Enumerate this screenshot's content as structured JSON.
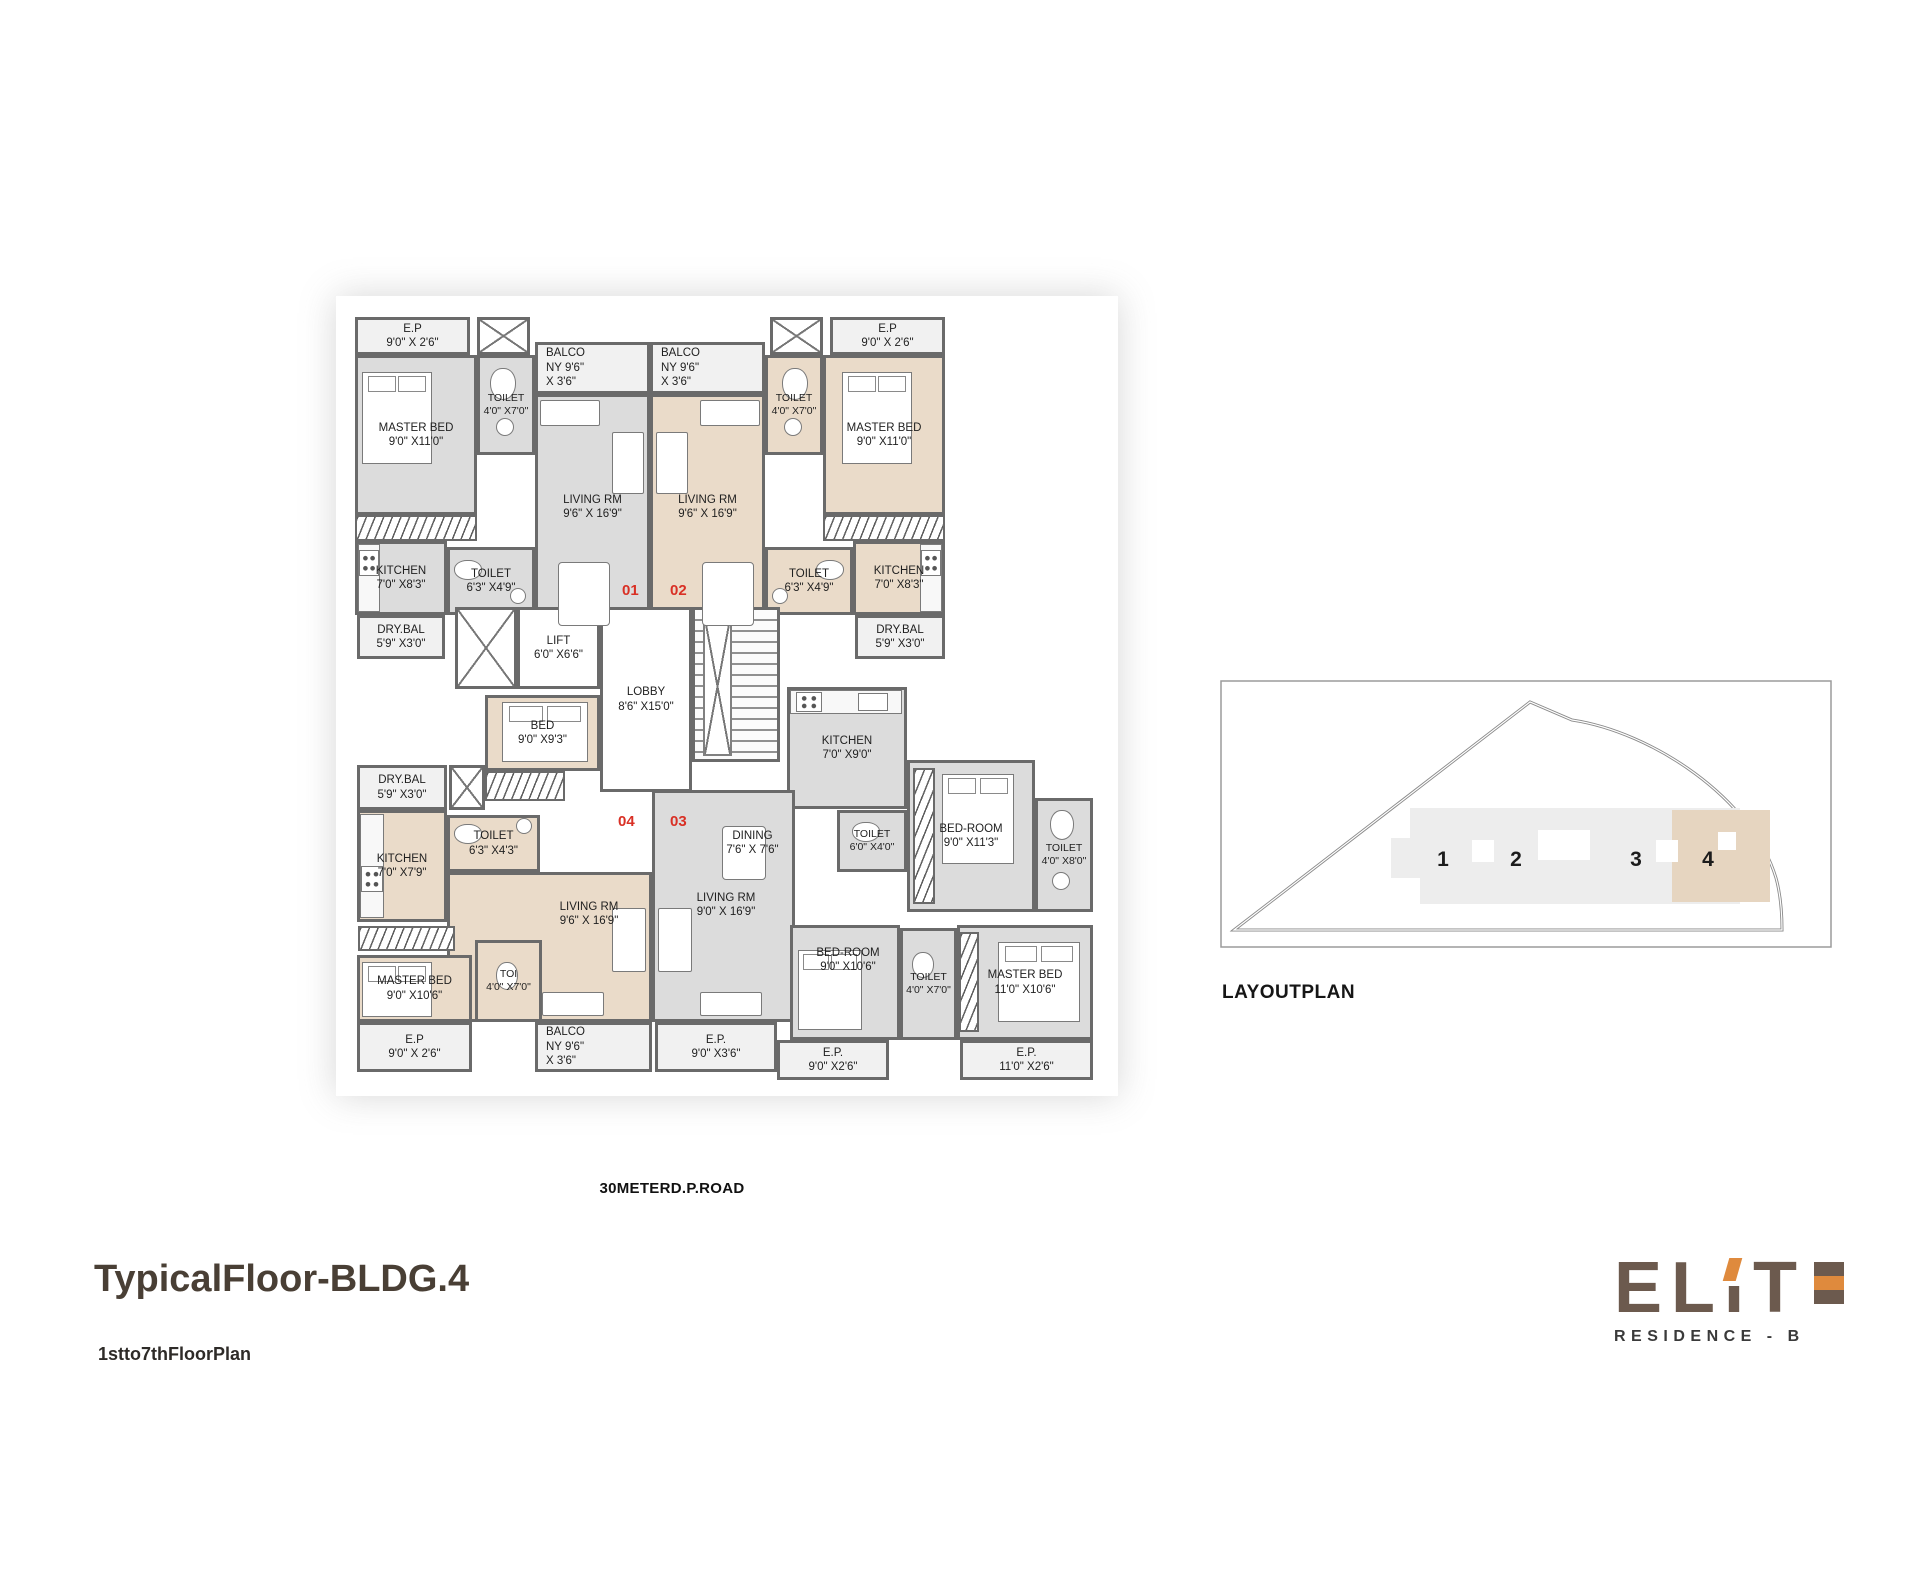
{
  "titles": {
    "main": "TypicalFloor-BLDG.4",
    "sub": "1stto7thFloorPlan"
  },
  "road_label": "30METERD.P.ROAD",
  "layout_plan": {
    "caption": "LAYOUTPLAN",
    "buildings": [
      "1",
      "2",
      "3",
      "4"
    ],
    "highlighted_building": "4"
  },
  "logo": {
    "letters": [
      "E",
      "L",
      "I",
      "T"
    ],
    "residence": "RESIDENCE - B",
    "brown": "#6c5a4e",
    "orange": "#df8a3d"
  },
  "colors": {
    "wall": "#6a6a6a",
    "unit_gray": "#dcdcdc",
    "unit_beige": "#eadbc9",
    "open_fill": "#f1f1f1",
    "unit_number_red": "#d93025"
  },
  "units": [
    {
      "number": "01",
      "x": 272,
      "y": 272
    },
    {
      "number": "02",
      "x": 320,
      "y": 272
    },
    {
      "number": "04",
      "x": 268,
      "y": 503
    },
    {
      "number": "03",
      "x": 320,
      "y": 503
    }
  ],
  "rooms": [
    {
      "id": "floor-unit-01",
      "nb": true,
      "fill": "g",
      "x": 5,
      "y": 45,
      "w": 295,
      "h": 263
    },
    {
      "id": "floor-unit-02",
      "nb": true,
      "fill": "b",
      "x": 300,
      "y": 45,
      "w": 295,
      "h": 263
    },
    {
      "id": "floor-unit-04",
      "nb": true,
      "fill": "b",
      "x": 7,
      "y": 455,
      "w": 295,
      "h": 257
    },
    {
      "id": "floor-unit-03-a",
      "nb": true,
      "fill": "g",
      "x": 437,
      "y": 450,
      "w": 248,
      "h": 262
    },
    {
      "id": "floor-unit-03-b",
      "nb": true,
      "fill": "g",
      "x": 302,
      "y": 480,
      "w": 143,
      "h": 232
    },
    {
      "id": "ep-01",
      "lines": [
        "E.P",
        "9'0\" X 2'6\""
      ],
      "fill": "open",
      "x": 5,
      "y": 7,
      "w": 115,
      "h": 38
    },
    {
      "id": "shaft-top-left",
      "type": "shaft",
      "x": 127,
      "y": 7,
      "w": 53,
      "h": 38
    },
    {
      "id": "master-bed-01",
      "lines": [
        "MASTER BED",
        "9'0\" X11'0\""
      ],
      "fill": "g",
      "x": 5,
      "y": 45,
      "w": 122,
      "h": 160
    },
    {
      "id": "toilet-01-a",
      "lines": [
        "TOILET",
        "4'0\" X7'0\""
      ],
      "fill": "g",
      "x": 127,
      "y": 45,
      "w": 58,
      "h": 100
    },
    {
      "id": "wardrobe-01",
      "type": "hatch",
      "x": 5,
      "y": 205,
      "w": 122,
      "h": 26
    },
    {
      "id": "kitchen-01",
      "lines": [
        "KITCHEN",
        "7'0\" X8'3\""
      ],
      "fill": "g",
      "x": 5,
      "y": 231,
      "w": 92,
      "h": 74
    },
    {
      "id": "toilet-01-b",
      "lines": [
        "TOILET",
        "6'3\" X4'9\""
      ],
      "fill": "g",
      "x": 97,
      "y": 237,
      "w": 88,
      "h": 68
    },
    {
      "id": "dry-bal-01",
      "lines": [
        "DRY.BAL",
        "5'9\" X3'0\""
      ],
      "fill": "open",
      "x": 7,
      "y": 305,
      "w": 88,
      "h": 44
    },
    {
      "id": "balcony-01",
      "lines": [
        "BALCO",
        "NY   9'6\"",
        "X 3'6\""
      ],
      "fill": "open",
      "align": "left",
      "x": 185,
      "y": 32,
      "w": 115,
      "h": 52
    },
    {
      "id": "living-01",
      "lines": [
        "LIVING RM",
        "9'6\" X 16'9\""
      ],
      "fill": "g",
      "x": 185,
      "y": 84,
      "w": 115,
      "h": 226
    },
    {
      "id": "balcony-02",
      "lines": [
        "BALCO",
        "NY   9'6\"",
        "X 3'6\""
      ],
      "fill": "open",
      "align": "left",
      "x": 300,
      "y": 32,
      "w": 115,
      "h": 52
    },
    {
      "id": "living-02",
      "lines": [
        "LIVING RM",
        "9'6\" X 16'9\""
      ],
      "fill": "b",
      "x": 300,
      "y": 84,
      "w": 115,
      "h": 226
    },
    {
      "id": "shaft-top-right",
      "type": "shaft",
      "x": 420,
      "y": 7,
      "w": 53,
      "h": 38
    },
    {
      "id": "toilet-02-a",
      "lines": [
        "TOILET",
        "4'0\" X7'0\""
      ],
      "fill": "b",
      "x": 415,
      "y": 45,
      "w": 58,
      "h": 100
    },
    {
      "id": "ep-02",
      "lines": [
        "E.P",
        "9'0\" X 2'6\""
      ],
      "fill": "open",
      "x": 480,
      "y": 7,
      "w": 115,
      "h": 38
    },
    {
      "id": "master-bed-02",
      "lines": [
        "MASTER BED",
        "9'0\" X11'0\""
      ],
      "fill": "b",
      "x": 473,
      "y": 45,
      "w": 122,
      "h": 160
    },
    {
      "id": "wardrobe-02",
      "type": "hatch",
      "x": 473,
      "y": 205,
      "w": 122,
      "h": 26
    },
    {
      "id": "kitchen-02",
      "lines": [
        "KITCHEN",
        "7'0\" X8'3\""
      ],
      "fill": "b",
      "x": 503,
      "y": 231,
      "w": 92,
      "h": 74
    },
    {
      "id": "toilet-02-b",
      "lines": [
        "TOILET",
        "6'3\" X4'9\""
      ],
      "fill": "b",
      "x": 415,
      "y": 237,
      "w": 88,
      "h": 68
    },
    {
      "id": "dry-bal-02",
      "lines": [
        "DRY.BAL",
        "5'9\" X3'0\""
      ],
      "fill": "open",
      "x": 505,
      "y": 305,
      "w": 90,
      "h": 44
    },
    {
      "id": "shaft-mid",
      "type": "shaft",
      "x": 105,
      "y": 297,
      "w": 62,
      "h": 82
    },
    {
      "id": "lift",
      "lines": [
        "LIFT",
        "6'0\" X6'6\""
      ],
      "fill": "white",
      "x": 167,
      "y": 297,
      "w": 83,
      "h": 82
    },
    {
      "id": "lobby",
      "lines": [
        "LOBBY",
        "8'6\" X15'0\""
      ],
      "fill": "white",
      "x": 250,
      "y": 297,
      "w": 92,
      "h": 185
    },
    {
      "id": "staircase",
      "type": "stairs",
      "x": 342,
      "y": 297,
      "w": 88,
      "h": 155
    },
    {
      "id": "bed-mid",
      "lines": [
        "BED",
        "9'0\" X9'3\""
      ],
      "fill": "b",
      "x": 135,
      "y": 385,
      "w": 115,
      "h": 76
    },
    {
      "id": "kitchen-03",
      "lines": [
        "KITCHEN",
        "7'0\" X9'0\""
      ],
      "fill": "g",
      "x": 437,
      "y": 377,
      "w": 120,
      "h": 122
    },
    {
      "id": "dry-bal-04",
      "lines": [
        "DRY.BAL",
        "5'9\" X3'0\""
      ],
      "fill": "open",
      "x": 7,
      "y": 455,
      "w": 90,
      "h": 45
    },
    {
      "id": "shaft-04",
      "type": "shaft",
      "x": 99,
      "y": 455,
      "w": 36,
      "h": 45
    },
    {
      "id": "wardrobe-04-a",
      "type": "hatch",
      "x": 135,
      "y": 461,
      "w": 80,
      "h": 30
    },
    {
      "id": "kitchen-04",
      "lines": [
        "KITCHEN",
        "7'0\" X7'9\""
      ],
      "fill": "b",
      "x": 7,
      "y": 500,
      "w": 90,
      "h": 112
    },
    {
      "id": "toilet-04-a",
      "lines": [
        "TOILET",
        "6'3\" X4'3\""
      ],
      "fill": "b",
      "x": 97,
      "y": 505,
      "w": 93,
      "h": 57
    },
    {
      "id": "living-04",
      "lines": [
        "LIVING RM",
        "9'6\" X 16'9\""
      ],
      "fill": "b",
      "lx": 139,
      "ly": 25,
      "x": 97,
      "y": 562,
      "w": 205,
      "h": 150
    },
    {
      "id": "wardrobe-04-b",
      "type": "hatch",
      "x": 8,
      "y": 616,
      "w": 97,
      "h": 25
    },
    {
      "id": "master-bed-04",
      "lines": [
        "MASTER BED",
        "9'0\" X10'6\""
      ],
      "fill": "b",
      "x": 7,
      "y": 645,
      "w": 115,
      "h": 67
    },
    {
      "id": "toi-04",
      "lines": [
        "TOI",
        "4'0\" X7'0\""
      ],
      "fill": "b",
      "x": 125,
      "y": 630,
      "w": 67,
      "h": 82
    },
    {
      "id": "balcony-04",
      "lines": [
        "BALCO",
        "NY   9'6\"",
        "X 3'6\""
      ],
      "fill": "open",
      "align": "left",
      "x": 185,
      "y": 712,
      "w": 117,
      "h": 50
    },
    {
      "id": "ep-04",
      "lines": [
        "E.P",
        "9'0\" X 2'6\""
      ],
      "fill": "open",
      "x": 7,
      "y": 712,
      "w": 115,
      "h": 50
    },
    {
      "id": "living-03",
      "lines": [
        "LIVING RM",
        "9'0\" X 16'9\""
      ],
      "fill": "g",
      "lx": 71,
      "ly": 98,
      "x": 302,
      "y": 480,
      "w": 143,
      "h": 232
    },
    {
      "id": "dining-03",
      "lines": [
        "DINING",
        "7'6\" X 7'6\""
      ],
      "nb": true,
      "fill": "none",
      "x": 350,
      "y": 498,
      "w": 105,
      "h": 70
    },
    {
      "id": "toilet-03-a",
      "lines": [
        "TOILET",
        "6'0\" X4'0\""
      ],
      "fill": "g",
      "x": 487,
      "y": 500,
      "w": 70,
      "h": 62
    },
    {
      "id": "bed-room-03-a",
      "lines": [
        "BED-ROOM",
        "9'0\" X11'3\""
      ],
      "fill": "g",
      "x": 557,
      "y": 450,
      "w": 128,
      "h": 152
    },
    {
      "id": "wardrobe-03-a",
      "type": "hatch",
      "x": 563,
      "y": 458,
      "w": 22,
      "h": 136
    },
    {
      "id": "toilet-03-b",
      "lines": [
        "TOILET",
        "4'0\" X8'0\""
      ],
      "fill": "g",
      "x": 685,
      "y": 488,
      "w": 58,
      "h": 114
    },
    {
      "id": "bed-room-03-b",
      "lines": [
        "BED-ROOM",
        "9'0\" X10'6\""
      ],
      "fill": "g",
      "lx": 55,
      "ly": 18,
      "x": 440,
      "y": 615,
      "w": 110,
      "h": 115
    },
    {
      "id": "toilet-03-c",
      "lines": [
        "TOILET",
        "4'0\" X7'0\""
      ],
      "fill": "g",
      "x": 550,
      "y": 618,
      "w": 57,
      "h": 112
    },
    {
      "id": "master-bed-03",
      "lines": [
        "MASTER BED",
        "11'0\" X10'6\""
      ],
      "fill": "g",
      "x": 607,
      "y": 615,
      "w": 136,
      "h": 115
    },
    {
      "id": "wardrobe-03-b",
      "type": "hatch",
      "x": 609,
      "y": 622,
      "w": 20,
      "h": 100
    },
    {
      "id": "ep-03-a",
      "lines": [
        "E.P.",
        "9'0\" X3'6\""
      ],
      "fill": "open",
      "x": 305,
      "y": 712,
      "w": 122,
      "h": 50
    },
    {
      "id": "ep-03-b",
      "lines": [
        "E.P.",
        "9'0\" X2'6\""
      ],
      "fill": "open",
      "x": 427,
      "y": 730,
      "w": 112,
      "h": 40
    },
    {
      "id": "ep-03-c",
      "lines": [
        "E.P.",
        "11'0\" X2'6\""
      ],
      "fill": "open",
      "x": 610,
      "y": 730,
      "w": 133,
      "h": 40
    }
  ],
  "furniture": [
    {
      "type": "bed",
      "x": 12,
      "y": 62,
      "w": 70,
      "h": 92
    },
    {
      "type": "bed",
      "x": 492,
      "y": 62,
      "w": 70,
      "h": 92
    },
    {
      "type": "bed",
      "x": 152,
      "y": 392,
      "w": 86,
      "h": 60
    },
    {
      "type": "bed",
      "x": 12,
      "y": 652,
      "w": 70,
      "h": 55
    },
    {
      "type": "bed",
      "x": 592,
      "y": 464,
      "w": 72,
      "h": 90
    },
    {
      "type": "bed",
      "x": 448,
      "y": 640,
      "w": 64,
      "h": 80
    },
    {
      "type": "bed",
      "x": 648,
      "y": 632,
      "w": 82,
      "h": 80
    },
    {
      "type": "wc",
      "x": 140,
      "y": 58,
      "w": 26,
      "h": 32
    },
    {
      "type": "wc",
      "x": 432,
      "y": 58,
      "w": 26,
      "h": 32
    },
    {
      "type": "wc",
      "x": 104,
      "y": 250,
      "w": 28,
      "h": 20
    },
    {
      "type": "wc",
      "x": 466,
      "y": 250,
      "w": 28,
      "h": 20
    },
    {
      "type": "wc",
      "x": 104,
      "y": 514,
      "w": 28,
      "h": 20
    },
    {
      "type": "wc",
      "x": 146,
      "y": 652,
      "w": 22,
      "h": 28
    },
    {
      "type": "wc",
      "x": 502,
      "y": 512,
      "w": 28,
      "h": 20
    },
    {
      "type": "wc",
      "x": 700,
      "y": 500,
      "w": 24,
      "h": 30
    },
    {
      "type": "wc",
      "x": 562,
      "y": 642,
      "w": 22,
      "h": 26
    },
    {
      "type": "basin",
      "x": 146,
      "y": 108,
      "w": 18,
      "h": 18
    },
    {
      "type": "basin",
      "x": 434,
      "y": 108,
      "w": 18,
      "h": 18
    },
    {
      "type": "basin",
      "x": 160,
      "y": 278,
      "w": 16,
      "h": 16
    },
    {
      "type": "basin",
      "x": 422,
      "y": 278,
      "w": 16,
      "h": 16
    },
    {
      "type": "basin",
      "x": 166,
      "y": 508,
      "w": 16,
      "h": 16
    },
    {
      "type": "basin",
      "x": 702,
      "y": 562,
      "w": 18,
      "h": 18
    },
    {
      "type": "table",
      "x": 208,
      "y": 252,
      "w": 52,
      "h": 64
    },
    {
      "type": "table",
      "x": 352,
      "y": 252,
      "w": 52,
      "h": 64
    },
    {
      "type": "table",
      "x": 372,
      "y": 516,
      "w": 44,
      "h": 54
    },
    {
      "type": "sofa",
      "x": 190,
      "y": 90,
      "w": 60,
      "h": 26
    },
    {
      "type": "sofa",
      "x": 262,
      "y": 122,
      "w": 32,
      "h": 62
    },
    {
      "type": "sofa",
      "x": 350,
      "y": 90,
      "w": 60,
      "h": 26
    },
    {
      "type": "sofa",
      "x": 306,
      "y": 122,
      "w": 32,
      "h": 62
    },
    {
      "type": "sofa",
      "x": 262,
      "y": 598,
      "w": 34,
      "h": 64
    },
    {
      "type": "sofa",
      "x": 192,
      "y": 682,
      "w": 62,
      "h": 24
    },
    {
      "type": "sofa",
      "x": 308,
      "y": 598,
      "w": 34,
      "h": 64
    },
    {
      "type": "sofa",
      "x": 350,
      "y": 682,
      "w": 62,
      "h": 24
    },
    {
      "type": "counter",
      "x": 8,
      "y": 234,
      "w": 22,
      "h": 68
    },
    {
      "type": "counter",
      "x": 570,
      "y": 234,
      "w": 22,
      "h": 68
    },
    {
      "type": "counter",
      "x": 440,
      "y": 380,
      "w": 112,
      "h": 24
    },
    {
      "type": "counter",
      "x": 10,
      "y": 504,
      "w": 24,
      "h": 104
    },
    {
      "type": "stove",
      "x": 9,
      "y": 240,
      "w": 20,
      "h": 26
    },
    {
      "type": "stove",
      "x": 571,
      "y": 240,
      "w": 20,
      "h": 26
    },
    {
      "type": "stove",
      "x": 446,
      "y": 382,
      "w": 26,
      "h": 20
    },
    {
      "type": "stove",
      "x": 11,
      "y": 556,
      "w": 22,
      "h": 26
    },
    {
      "type": "sink",
      "x": 508,
      "y": 383,
      "w": 30,
      "h": 18
    }
  ]
}
